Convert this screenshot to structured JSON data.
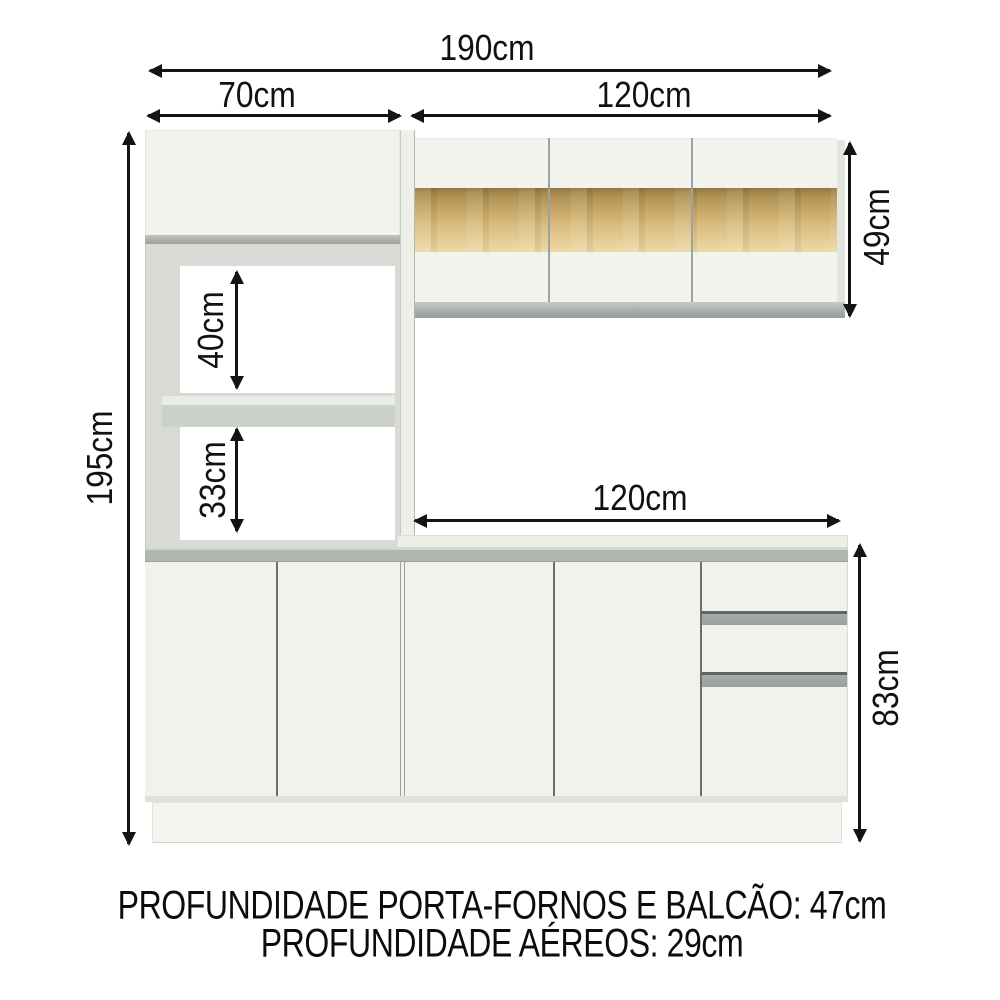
{
  "dimensions": {
    "total_width": "190cm",
    "tower_width": "70cm",
    "aereo_width": "120cm",
    "total_height": "195cm",
    "niche_upper_height": "40cm",
    "niche_lower_height": "33cm",
    "balcao_width": "120cm",
    "aereo_height": "49cm",
    "balcao_height": "83cm"
  },
  "footer": {
    "line1": "PROFUNDIDADE PORTA-FORNOS E BALCÃO: 47cm",
    "line2": "PROFUNDIDADE AÉREOS: 29cm"
  },
  "colors": {
    "background": "#ffffff",
    "cabinet_white": "#f2f3ed",
    "frame_gray": "#d8dbd5",
    "profile_gray": "#a9aeab",
    "counter_gray": "#b4b8b4",
    "wood_band_top": "#8e733f",
    "wood_band_mid": "#c6a562",
    "wood_band_bottom": "#ecd9a4",
    "annotation": "#141414"
  }
}
